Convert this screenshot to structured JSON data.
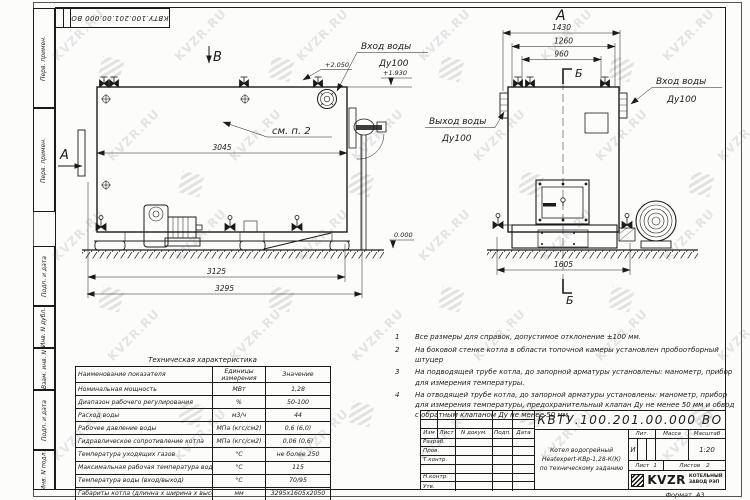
{
  "sheet": {
    "stamp_top": "КВТУ.100.201.00.000 ВО",
    "format_label": "Формат",
    "format_value": "А3",
    "margin_labels": [
      "Перв. примен.",
      "Перв. примен.",
      "Подп. и дата",
      "Инв. N дубл.",
      "Взам. инв. N",
      "Подп. и дата",
      "Инв. N подл."
    ]
  },
  "watermark": {
    "text": "KVZR.RU"
  },
  "views": {
    "left": {
      "view_label": "В",
      "section_label": "А",
      "note_ref": "см. п. 2",
      "inlet_line1": "Вход воды",
      "inlet_line2": "Ду100",
      "elev_top": "+2.050",
      "elev_mid": "+1.930",
      "elev_zero": "0.000",
      "dim_shell": "3045",
      "dim_frame": "3125",
      "dim_overall": "3295"
    },
    "front": {
      "view_label": "А",
      "section_label_top": "Б",
      "section_label_bottom": "Б",
      "outlet_line1": "Выход воды",
      "outlet_line2": "Ду100",
      "inlet_line1": "Вход воды",
      "inlet_line2": "Ду100",
      "dim_overall": "1430",
      "dim_mid": "1260",
      "dim_inner": "960",
      "dim_base": "1605"
    }
  },
  "notes": {
    "items": [
      {
        "num": "1",
        "text": "Все размеры для справок, допустимое отклонение  ±100 мм."
      },
      {
        "num": "2",
        "text": "На боковой стенке котла в области топочной камеры установлен пробоотборный штуцер"
      },
      {
        "num": "3",
        "text": "На  подводящей трубе котла, до запорной арматуры установлены: манометр, прибор для измерения температуры."
      },
      {
        "num": "4",
        "text": "На отводящей трубе котла, до запорной арматуры установлены: манометр, прибор для измерения температуры, предохранительный клапан Ду не менее 50 мм и обвод с обратным клапаном  Ду не менее 50 мм."
      }
    ]
  },
  "tech_table": {
    "title": "Техническая характеристика",
    "headers": {
      "name": "Наименование показателя",
      "units1": "Единицы",
      "units2": "измерения",
      "value": "Значение"
    },
    "rows": [
      {
        "name": "Номинальная мощность",
        "units": "МВт",
        "value": "1,28"
      },
      {
        "name": "Диапазон рабочего регулирования",
        "units": "%",
        "value": "50-100"
      },
      {
        "name": "Расход воды",
        "units": "м3/ч",
        "value": "44"
      },
      {
        "name": "Рабочее давление воды",
        "units": "МПа (кгс/см2)",
        "value": "0,6 (6,0)"
      },
      {
        "name": "Гидравлическое сопротивление котла",
        "units": "МПа (кгс/см2)",
        "value": "0,06 (0,6)"
      },
      {
        "name": "Температура уходящих газов",
        "units": "°С",
        "value": "не более 250"
      },
      {
        "name": "Максимальная рабочая температура воды",
        "units": "°С",
        "value": "115"
      },
      {
        "name": "Температура воды (вход/выход)",
        "units": "°С",
        "value": "70/95"
      },
      {
        "name": "Габариты котла (длинна х ширина х высота)",
        "units": "мм",
        "value": "3295х1605х2050"
      }
    ]
  },
  "title_block": {
    "doc_number": "КВТУ.100.201.00.000  ВО",
    "header_cols": [
      "Изм",
      "Лист",
      "N докум.",
      "Подп.",
      "Дата"
    ],
    "row_labels": [
      "Разраб.",
      "Пров.",
      "Т.контр.",
      "",
      "Н.контр.",
      "Утв."
    ],
    "title_line1": "Котел водогрейный",
    "title_line2": "Heatexpert-КВр-1,28-К(К)",
    "title_line3": "по техническому заданию",
    "lit_header": "Лит.",
    "mass_header": "Масса",
    "scale_header": "Масштаб",
    "lit_value": "И",
    "scale_value": "1:20",
    "sheet_label": "Лист",
    "sheet_value": "1",
    "sheets_label": "Листов",
    "sheets_value": "2",
    "company_logo": "KVZR",
    "company_line1": "КОТЕЛЬНЫЙ",
    "company_line2": "ЗАВОД РЭП"
  }
}
